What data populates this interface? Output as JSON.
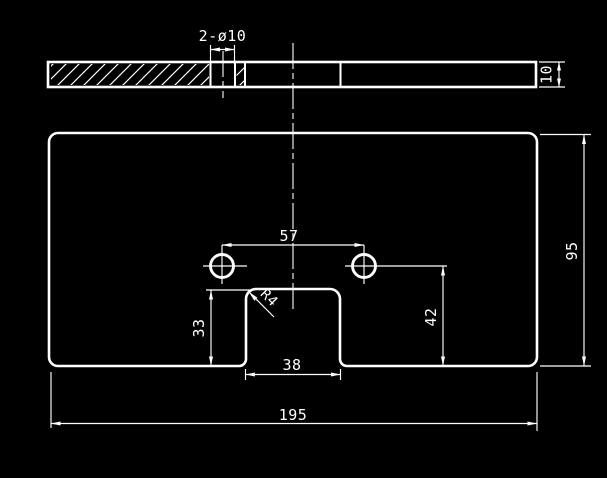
{
  "canvas": {
    "background_color": "#000000",
    "stroke_color": "#ffffff"
  },
  "section_view": {
    "hole_callout": "2-ø10",
    "thickness_dim": "10"
  },
  "front_view": {
    "hole_spacing_dim": "57",
    "height_dim": "95",
    "hole_height_dim": "42",
    "notch_depth_dim": "33",
    "notch_width_dim": "38",
    "width_dim": "195",
    "corner_radius_label": "R4"
  }
}
